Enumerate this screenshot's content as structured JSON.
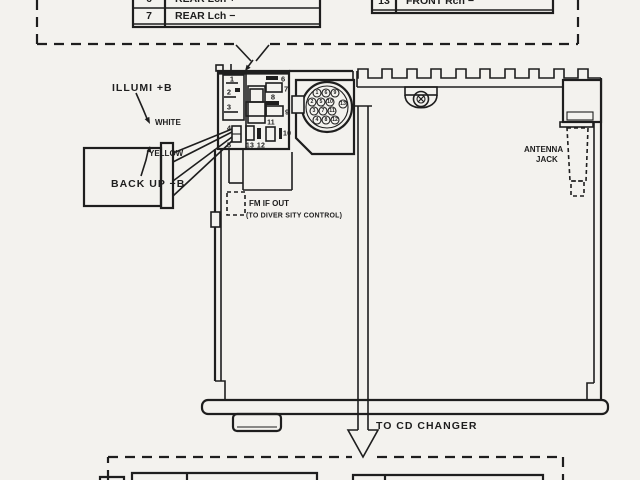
{
  "diagram": {
    "title_hint": "car-stereo-wiring-diagram",
    "colors": {
      "ink": "#1e1e1e",
      "paper": "#f3f2ee"
    },
    "top_tables": {
      "left": {
        "rows": [
          {
            "pin": "6",
            "label": "REAR Lch +"
          },
          {
            "pin": "7",
            "label": "REAR Lch −"
          }
        ]
      },
      "right": {
        "rows": [
          {
            "pin": "13",
            "label": "FRONT Rch −"
          }
        ]
      }
    },
    "wire_labels": {
      "illumi": "ILLUMI +B",
      "white": "WHITE",
      "yellow": "YELLOW",
      "backup": "BACK UP +B"
    },
    "fm": {
      "line1": "FM IF OUT",
      "line2": "(TO DIVER SITY CONTROL)"
    },
    "antenna": {
      "line1": "ANTENNA",
      "line2": "JACK"
    },
    "cd": {
      "label": "TO CD CHANGER"
    },
    "connector_block": {
      "pins": [
        "1",
        "2",
        "3",
        "4",
        "5",
        "6",
        "7",
        "8",
        "9",
        "10",
        "11",
        "12",
        "13"
      ]
    },
    "din": {
      "pins": [
        "1",
        "6",
        "9",
        "2",
        "5",
        "10",
        "13",
        "3",
        "7",
        "11",
        "4",
        "8",
        "12"
      ]
    }
  }
}
